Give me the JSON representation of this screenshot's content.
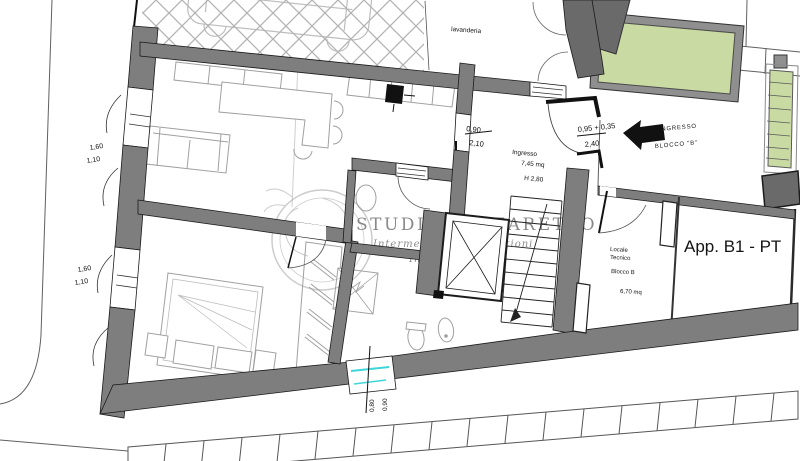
{
  "plan": {
    "title": "App. B1 - PT",
    "watermark": {
      "line1": "STUDIO LAZZARETTO",
      "line2": "Intermediazioni e Gestioni",
      "line3": "Immobiliari"
    },
    "rooms": {
      "lavanderia": "lavanderia",
      "ingresso": {
        "name": "Ingresso",
        "area": "7,45 mq",
        "height": "H 2,80"
      },
      "locale_tecnico": {
        "name_line1": "Locale",
        "name_line2": "Tecnico",
        "block": "Blocco B",
        "area": "6,70 mq"
      }
    },
    "entrance_block_b": {
      "line1": "INGRESSO",
      "line2": "BLOCCO \"B\""
    },
    "dimensions": {
      "interior_door": {
        "width": "0,90",
        "height": "2,10"
      },
      "entrance_door": {
        "width": "0,95 + 0,35",
        "height": "2,40"
      },
      "window_left_upper": {
        "width": "1,60",
        "sill": "1,10"
      },
      "window_left_lower": {
        "width": "1,60",
        "sill": "1,10"
      },
      "window_bottom": {
        "width": "0,80",
        "height": "0,90"
      }
    },
    "colors": {
      "wall": "#7e7e7e",
      "wall_dark": "#6a6a6a",
      "outline": "#1a1a1a",
      "green": "#c9daa3",
      "cyan": "#3fd6d9",
      "furniture": "#a0a0a0",
      "watermark": "#9a9a9a"
    }
  }
}
